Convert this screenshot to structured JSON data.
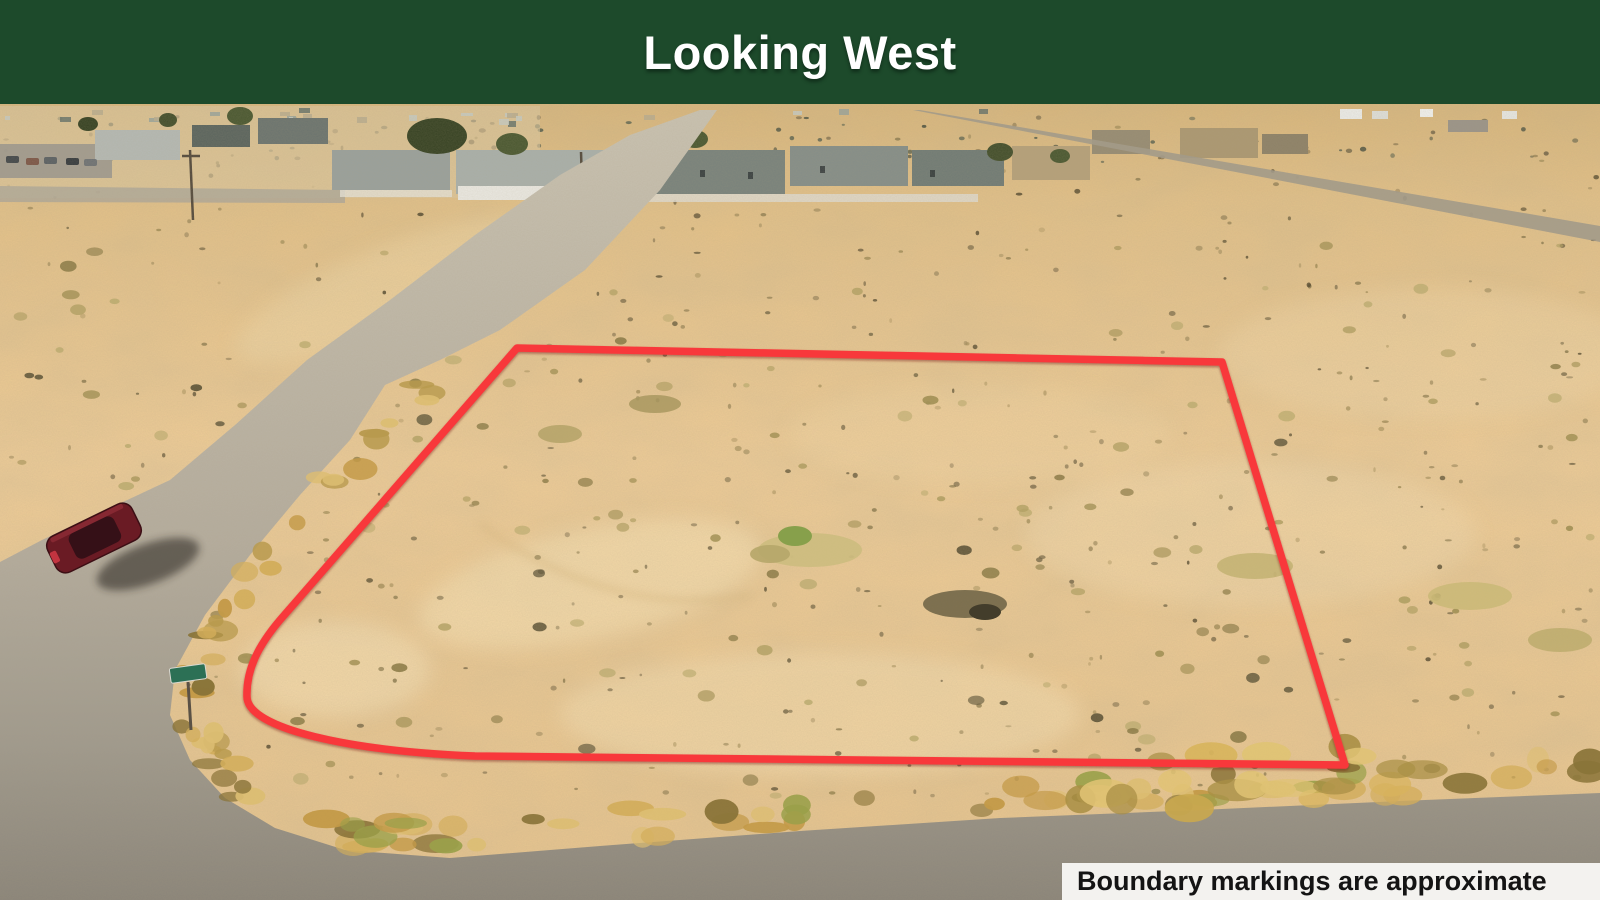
{
  "header": {
    "title": "Looking West"
  },
  "photo": {
    "caption": "Boundary markings are approximate",
    "alt": "Aerial drone photo looking west over a flat tan desert parcel outlined with a red boundary line; a gravel road runs along the left side, a wider dirt road crosses the bottom, a dark red car is parked on the left road, and houses line the horizon at the upper left"
  },
  "colors": {
    "banner_bg": "#1d4a2b",
    "banner_text": "#ffffff",
    "boundary_red": "#f8393b",
    "caption_bg": "#f3f2ef",
    "caption_text": "#141414",
    "sand": "#eccb96",
    "road_gray": "#b2aa9b",
    "car_body": "#6a1b24"
  }
}
